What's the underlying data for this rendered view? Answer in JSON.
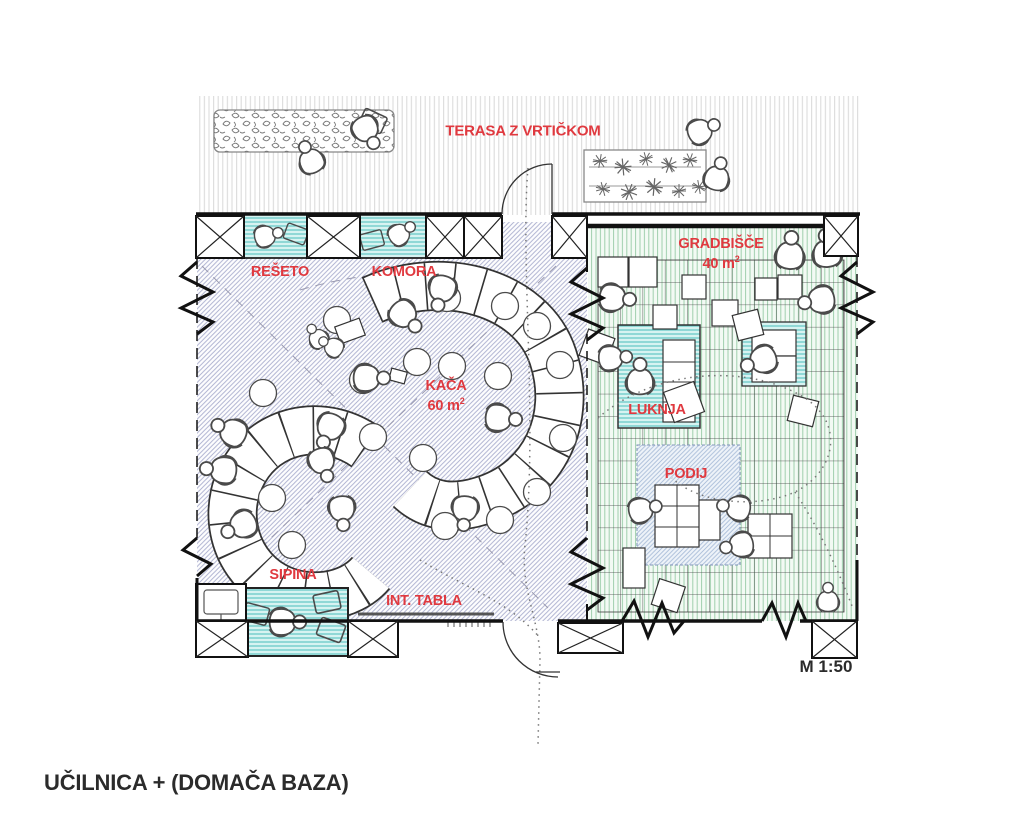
{
  "drawing": {
    "title": "UČILNICA + (DOMAČA BAZA)",
    "scale": "M 1:50",
    "rooms": {
      "terasa": {
        "label": "TERASA Z VRTIČKOM"
      },
      "reseto": {
        "label": "REŠETO"
      },
      "komora": {
        "label": "KOMORA"
      },
      "kaca": {
        "label": "KAČA",
        "area_value": "60 m",
        "area_sup": "2"
      },
      "gradbisce": {
        "label": "GRADBIŠČE",
        "area_value": "40 m",
        "area_sup": "2"
      },
      "luknja": {
        "label": "LUKNJA"
      },
      "podij": {
        "label": "PODIJ"
      },
      "sipina": {
        "label": "SIPINA"
      },
      "int_tabla": {
        "label": "INT. TABLA"
      }
    },
    "colors": {
      "label_red": "#E0393F",
      "ink": "#111111",
      "teal_fill": "#d7f3f1",
      "teal_line": "#57c3bf",
      "lavender_line": "#adb1d0",
      "green_line": "#9fcfad",
      "podij_line": "#a8bcd8"
    }
  }
}
